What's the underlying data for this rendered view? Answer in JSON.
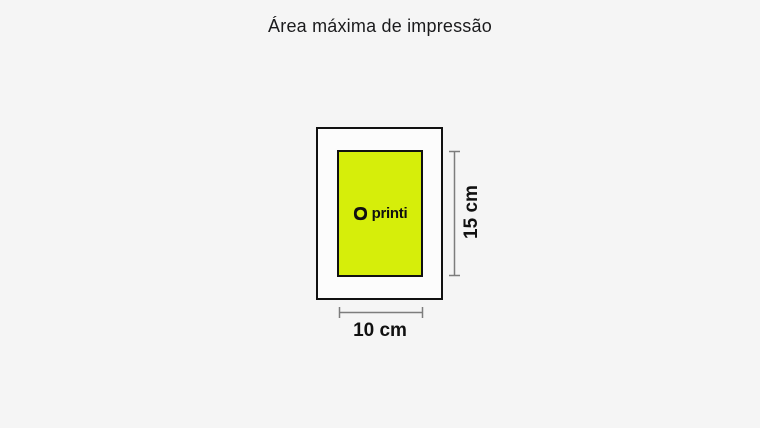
{
  "title": "Área máxima de impressão",
  "diagram": {
    "logo_text": "printi",
    "height_label": "15 cm",
    "width_label": "10 cm",
    "icons": {
      "logo_mark": "printi-ring-icon"
    },
    "colors": {
      "page_background": "#f5f5f5",
      "frame_fill": "#fcfcfc",
      "print_area_fill": "#d6ee0a",
      "border": "#111111",
      "dimension_line": "#7d7d7d",
      "text": "#1b1b1d"
    }
  }
}
